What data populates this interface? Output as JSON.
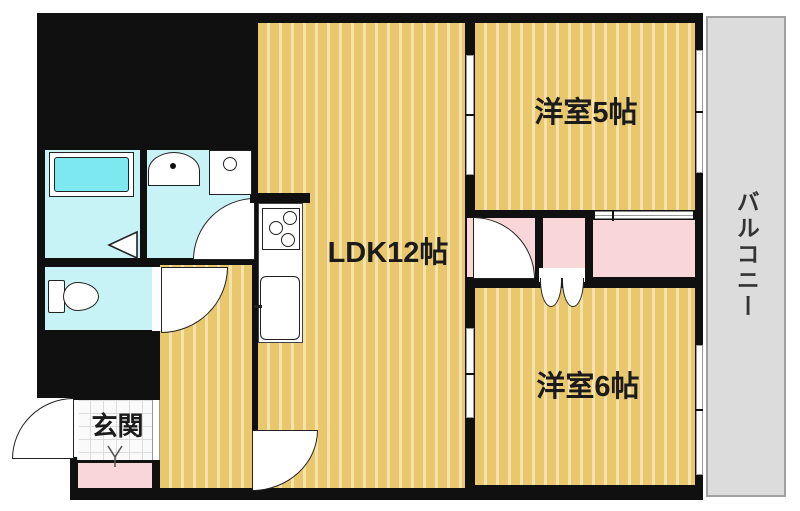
{
  "floorplan": {
    "title": "apartment-floor-plan",
    "rooms": {
      "ldk": {
        "label": "LDK12帖"
      },
      "bedroom5": {
        "label": "洋室5帖"
      },
      "bedroom6": {
        "label": "洋室6帖"
      },
      "entrance": {
        "label": "玄関"
      },
      "balcony": {
        "label": "バルコニー"
      }
    },
    "colors": {
      "wall": "#101010",
      "floor_tan": "#e9c76d",
      "floor_stripe": "#f6e3ae",
      "water_cyan": "#c7f3f6",
      "bathtub_cyan": "#7ee8f0",
      "closet_pink": "#f9d6d8",
      "balcony_gray": "#dcdcdc",
      "page_bg": "#ffffff"
    }
  }
}
